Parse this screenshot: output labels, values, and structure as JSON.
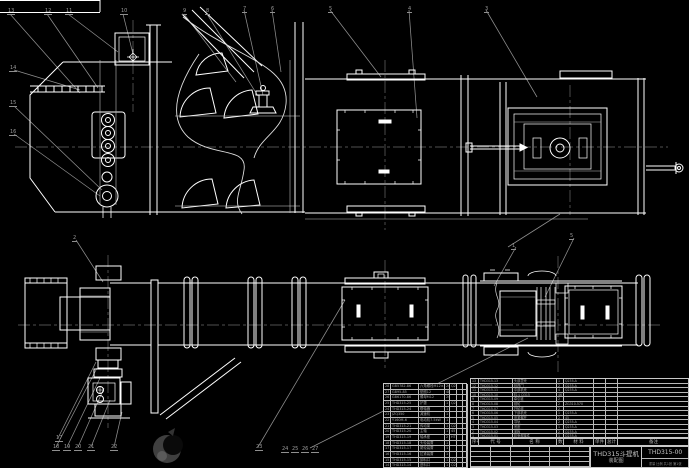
{
  "colors": {
    "background": "#000000",
    "line": "#ffffff",
    "thin_line": "#cfcfcf",
    "leader": "#8f8f8f",
    "centerline": "#6a6a6a",
    "table_text": "#a8a8a8",
    "title_text": "#c4c4c4"
  },
  "title_block": {
    "product": "THD315斗提机",
    "drawing_type": "装配图",
    "drawing_no": "THD315-00",
    "info_row": "重量  比例  共1张 第1张"
  },
  "bom": {
    "header": [
      "序号",
      "代  号",
      "名  称",
      "数量",
      "材  料",
      "单件",
      "总计",
      "备注"
    ],
    "left_rows": [
      [
        "28",
        "GB5782-86",
        "六角螺栓M12×45",
        "24",
        "Q235",
        "",
        ""
      ],
      [
        "27",
        "GB95-85",
        "垫圈12",
        "48",
        "",
        "",
        ""
      ],
      [
        "26",
        "GB6170-86",
        "螺母M12",
        "24",
        "",
        "",
        ""
      ],
      [
        "25",
        "THD315-25",
        "护罩",
        "1",
        "Q235-A",
        "",
        ""
      ],
      [
        "24",
        "THD315-24",
        "联轴器",
        "1",
        "",
        "",
        ""
      ],
      [
        "23",
        "JZQ350",
        "减速机",
        "1",
        "",
        "",
        ""
      ],
      [
        "22",
        "Y160M-6",
        "电动机7.5kW",
        "1",
        "",
        "",
        ""
      ],
      [
        "21",
        "THD315-21",
        "传动架",
        "1",
        "Q235-A",
        "",
        ""
      ],
      [
        "20",
        "THD315-20",
        "主轴",
        "1",
        "45",
        "",
        ""
      ],
      [
        "19",
        "THD315-19",
        "轴承座",
        "2",
        "HT200",
        "",
        ""
      ],
      [
        "18",
        "THD315-18",
        "头轮装置",
        "1",
        "",
        "",
        ""
      ],
      [
        "17",
        "THD315-17",
        "尾轮装置",
        "1",
        "",
        "",
        ""
      ],
      [
        "16",
        "THD315-16",
        "拉紧装置",
        "1",
        "",
        "",
        ""
      ],
      [
        "15",
        "THD315-15",
        "卸料口",
        "1",
        "Q235-A",
        "",
        ""
      ],
      [
        "14",
        "THD315-14",
        "进料口",
        "1",
        "Q235-A",
        "",
        ""
      ]
    ],
    "right_rows": [
      [
        "13",
        "THD315-13",
        "头部罩壳",
        "1",
        "Q235-A",
        "",
        "",
        ""
      ],
      [
        "12",
        "THD315-12",
        "检视门",
        "2",
        "Q235-A",
        "",
        "",
        ""
      ],
      [
        "11",
        "THD315-11",
        "中部机壳",
        "4",
        "Q235-A",
        "",
        "",
        ""
      ],
      [
        "10",
        "THD315-10",
        "料斗 D315",
        "46",
        "",
        "",
        "",
        ""
      ],
      [
        "9",
        "THD315-09",
        "牵引链",
        "2",
        "",
        "",
        "",
        ""
      ],
      [
        "8",
        "THD315-08",
        "链轮",
        "2",
        "ZG310-570",
        "",
        "",
        ""
      ],
      [
        "7",
        "THD315-07",
        "托轮组",
        "2",
        "",
        "",
        "",
        ""
      ],
      [
        "6",
        "THD315-06",
        "下部机壳",
        "1",
        "Q235-A",
        "",
        "",
        ""
      ],
      [
        "5",
        "THD315-05",
        "张紧螺杆",
        "2",
        "45",
        "",
        "",
        ""
      ],
      [
        "4",
        "THD315-04",
        "导轨",
        "2",
        "Q235-A",
        "",
        "",
        ""
      ],
      [
        "3",
        "THD315-03",
        "底座",
        "1",
        "Q235-A",
        "",
        "",
        ""
      ],
      [
        "2",
        "THD315-02",
        "盖板",
        "2",
        "Q235-A",
        "",
        "",
        ""
      ],
      [
        "1",
        "THD315-01",
        "机壳焊接件",
        "1",
        "Q235-A",
        "",
        "",
        ""
      ]
    ]
  },
  "callouts": [
    {
      "label": "13",
      "x": 7,
      "y": 9
    },
    {
      "label": "12",
      "x": 44,
      "y": 9
    },
    {
      "label": "11",
      "x": 65,
      "y": 9
    },
    {
      "label": "10",
      "x": 120,
      "y": 9
    },
    {
      "label": "9",
      "x": 182,
      "y": 9
    },
    {
      "label": "8",
      "x": 205,
      "y": 9
    },
    {
      "label": "7",
      "x": 242,
      "y": 7
    },
    {
      "label": "6",
      "x": 270,
      "y": 7
    },
    {
      "label": "5",
      "x": 328,
      "y": 7
    },
    {
      "label": "4",
      "x": 407,
      "y": 7
    },
    {
      "label": "3",
      "x": 484,
      "y": 7
    },
    {
      "label": "14",
      "x": 9,
      "y": 66
    },
    {
      "label": "15",
      "x": 9,
      "y": 101
    },
    {
      "label": "16",
      "x": 9,
      "y": 130
    },
    {
      "label": "2",
      "x": 72,
      "y": 236
    },
    {
      "label": "1",
      "x": 511,
      "y": 244
    },
    {
      "label": "5",
      "x": 569,
      "y": 234
    },
    {
      "label": "17",
      "x": 55,
      "y": 436
    },
    {
      "label": "18",
      "x": 52,
      "y": 445
    },
    {
      "label": "19",
      "x": 63,
      "y": 445
    },
    {
      "label": "20",
      "x": 74,
      "y": 445
    },
    {
      "label": "21",
      "x": 87,
      "y": 445
    },
    {
      "label": "22",
      "x": 110,
      "y": 445
    },
    {
      "label": "23",
      "x": 255,
      "y": 445
    },
    {
      "label": "24",
      "x": 281,
      "y": 447
    },
    {
      "label": "25",
      "x": 291,
      "y": 447
    },
    {
      "label": "26",
      "x": 301,
      "y": 447
    },
    {
      "label": "27",
      "x": 311,
      "y": 447
    }
  ]
}
